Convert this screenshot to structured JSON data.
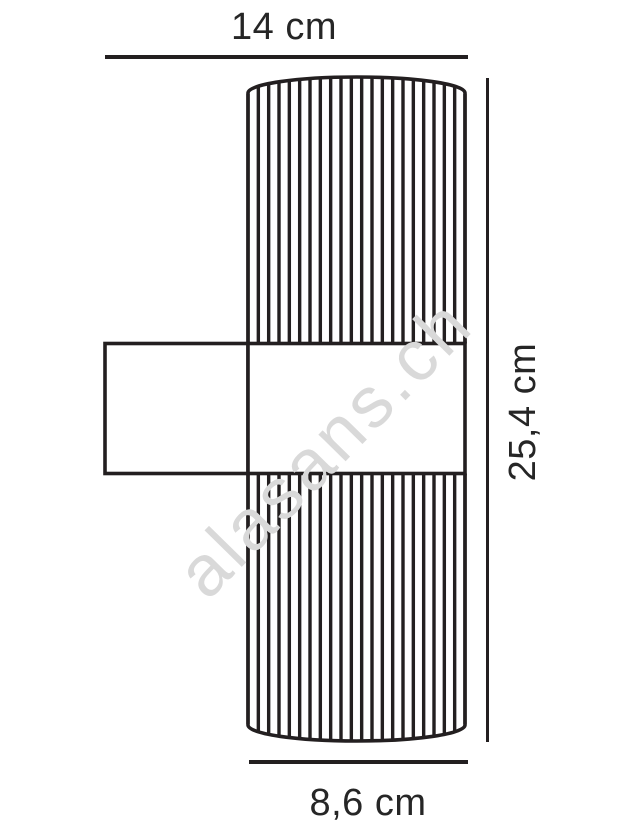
{
  "diagram": {
    "type": "technical-dimension-drawing",
    "subject": "fluted cylindrical wall lamp, side elevation",
    "labels": {
      "width_top": "14 cm",
      "height_right": "25,4 cm",
      "diameter_bottom": "8,6 cm"
    },
    "watermark": "alasans.ch",
    "colors": {
      "background": "#ffffff",
      "line": "#231f20",
      "text": "#262626",
      "watermark": "#d9d9d9"
    }
  }
}
